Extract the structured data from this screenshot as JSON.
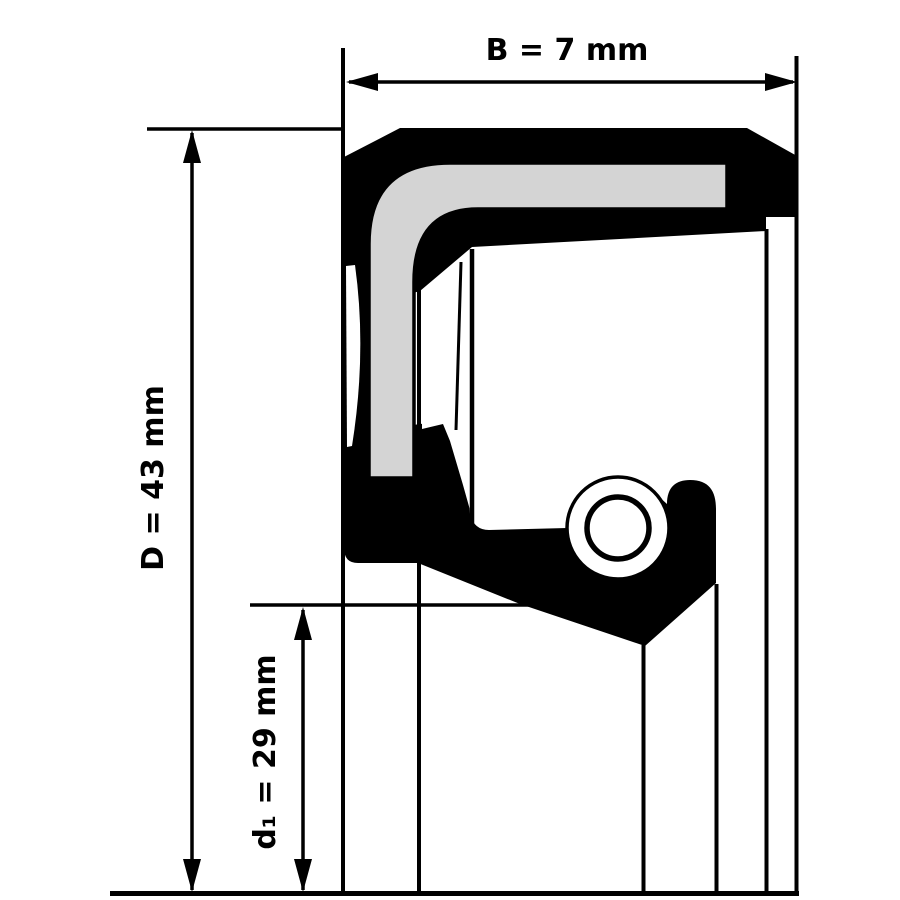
{
  "drawing": {
    "subject": "radial shaft seal cross-section",
    "labels": {
      "width": "B = 7 mm",
      "outer_diameter": "D = 43 mm",
      "inner_diameter": "d₁ = 29 mm"
    },
    "values_mm": {
      "B": 7,
      "D": 43,
      "d1": 29
    },
    "colors": {
      "lines": "#000000",
      "rubber_body": "#000000",
      "metal_insert": "#d4d4d4",
      "background": "#ffffff"
    }
  }
}
